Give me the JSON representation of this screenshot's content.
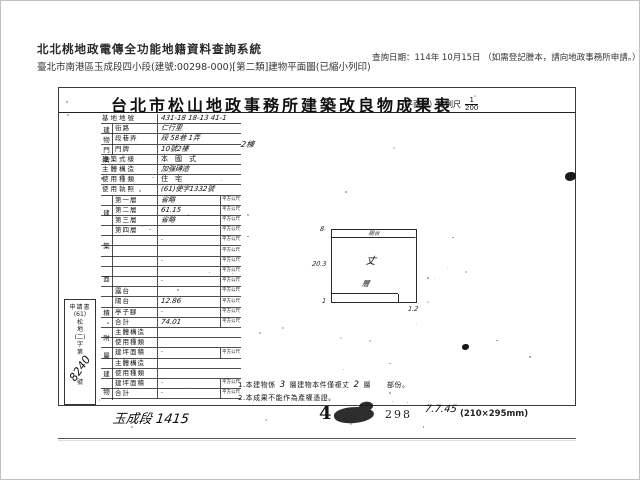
{
  "system_header": {
    "title": "北北桃地政電傳全功能地籍資料查詢系統",
    "subtitle": "臺北市南港區玉成段四小段(建號:00298-000)[第二類]建物平面圖(已縮小列印)",
    "query_date": "查詢日期：114年 10月15日 （如需登記謄本，請向地政事務所申請。）"
  },
  "document": {
    "title": "台北市松山地政事務所建築改良物成果表",
    "scale_prefix": "（平面圖）比例尺",
    "scale_numerator": "1",
    "scale_denominator": "200",
    "application": {
      "label": "申請書",
      "number_tokens": [
        "(61)",
        "松",
        "地",
        "(二)",
        "字",
        "第"
      ],
      "number_hw": "8240",
      "number_suffix": "號"
    },
    "table": {
      "area_unit": "平方公尺",
      "door_overflow": "2棟",
      "spines": [
        {
          "text": "建物門牌",
          "start": 1,
          "span": 3
        },
        {
          "text": "建築面積",
          "start": 8,
          "span": 13
        },
        {
          "text": "附屬建物",
          "start": 21,
          "span": 7
        }
      ],
      "rows": [
        {
          "label": "基地地號",
          "value": "431-18 18-13 41-1",
          "hw": true,
          "full": true,
          "unit": false
        },
        {
          "label": "街路",
          "value": "仁行里",
          "hw": true,
          "full": false,
          "unit": false
        },
        {
          "label": "段巷弄",
          "value": "段 58巷 1弄",
          "hw": true,
          "full": false,
          "unit": false
        },
        {
          "label": "門牌",
          "value": "10號2樓",
          "hw": true,
          "full": false,
          "unit": false
        },
        {
          "label": "建築式樣",
          "value": "本　國　式",
          "hw": false,
          "full": true,
          "unit": false
        },
        {
          "label": "主體構造",
          "value": "加強磚造",
          "hw": true,
          "full": true,
          "unit": false
        },
        {
          "label": "使用種類",
          "value": "住　宅",
          "hw": false,
          "full": true,
          "unit": false
        },
        {
          "label": "使用執照",
          "value": "(61)使字1332號",
          "hw": true,
          "full": true,
          "unit": false
        },
        {
          "label": "第一層",
          "value": "省略",
          "hw": true,
          "full": false,
          "unit": true
        },
        {
          "label": "第二層",
          "value": "61.15",
          "hw": true,
          "full": false,
          "unit": true
        },
        {
          "label": "第三層",
          "value": "省略",
          "hw": true,
          "full": false,
          "unit": true
        },
        {
          "label": "第四層",
          "value": "",
          "hw": false,
          "full": false,
          "unit": true
        },
        {
          "label": "",
          "value": "·",
          "hw": false,
          "full": false,
          "unit": true
        },
        {
          "label": "",
          "value": "",
          "hw": false,
          "full": false,
          "unit": true
        },
        {
          "label": "",
          "value": "·",
          "hw": false,
          "full": false,
          "unit": true
        },
        {
          "label": "",
          "value": "",
          "hw": false,
          "full": false,
          "unit": true
        },
        {
          "label": "",
          "value": "·",
          "hw": false,
          "full": false,
          "unit": true
        },
        {
          "label": "露台",
          "value": "",
          "hw": false,
          "full": false,
          "unit": true
        },
        {
          "label": "陽台",
          "value": "12.86",
          "hw": true,
          "full": false,
          "unit": true
        },
        {
          "label": "亭子腳",
          "value": "·",
          "hw": false,
          "full": false,
          "unit": true
        },
        {
          "label": "合計",
          "value": "74.01",
          "hw": true,
          "full": false,
          "unit": true
        },
        {
          "label": "主體構造",
          "value": "",
          "hw": false,
          "full": false,
          "unit": false
        },
        {
          "label": "使用種類",
          "value": "",
          "hw": false,
          "full": false,
          "unit": false
        },
        {
          "label": "建坪面積",
          "value": "·",
          "hw": false,
          "full": false,
          "unit": true
        },
        {
          "label": "主體構造",
          "value": "",
          "hw": false,
          "full": false,
          "unit": false
        },
        {
          "label": "使用種類",
          "value": "",
          "hw": false,
          "full": false,
          "unit": false
        },
        {
          "label": "建坪面積",
          "value": "·",
          "hw": false,
          "full": false,
          "unit": true
        },
        {
          "label": "合計",
          "value": "·",
          "hw": false,
          "full": false,
          "unit": true
        }
      ]
    },
    "plan": {
      "balcony_label": "陽台",
      "center_mark": "丈",
      "floor_mark": "層",
      "dim_top_left": "8",
      "dim_left": "20.3",
      "dim_bottom_left": "1",
      "dim_bottom_right": "1.2"
    },
    "notes": {
      "n1a": "1.本建物係",
      "n1hw1": "3",
      "n1b": "層建物本件僅複丈",
      "n1hw2": "2",
      "n1c": "層",
      "n1d": "部份。",
      "line2": "2.本成果不能作為產權憑證。"
    },
    "footer": {
      "section_hw": "玉成段 1415",
      "page_marker": "4",
      "doc_number": "298",
      "hw_number": "7.7.45",
      "paper_size": "(210×295mm)"
    }
  },
  "colors": {
    "ink": "#161616",
    "paper": "#ffffff",
    "header_text": "#2b2b2b"
  }
}
